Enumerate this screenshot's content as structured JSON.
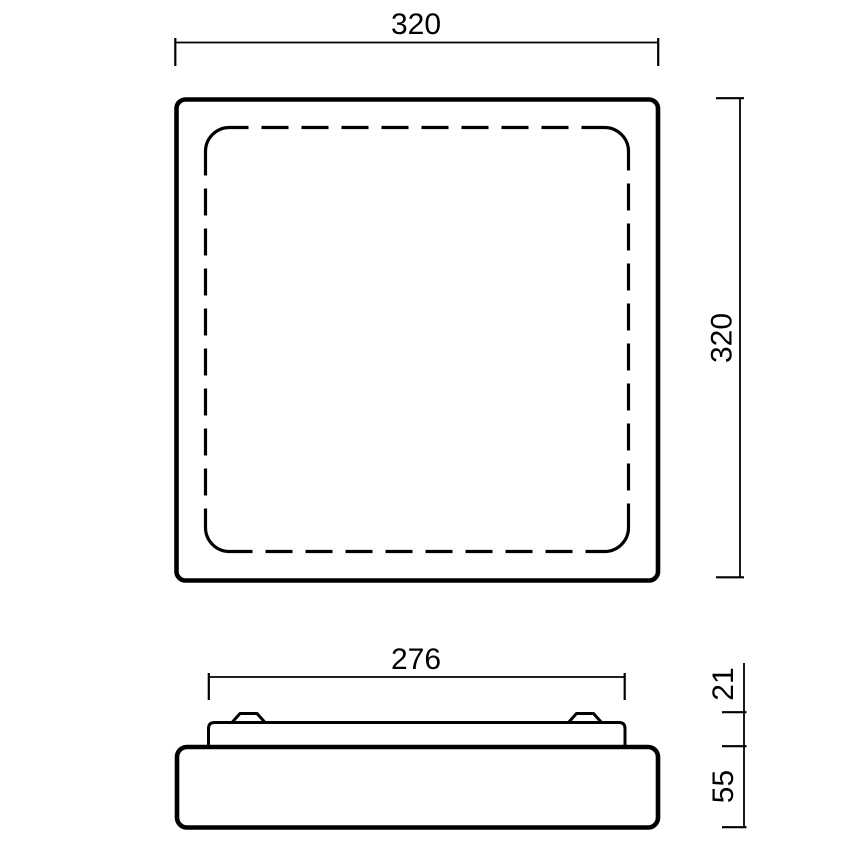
{
  "meta": {
    "drawing_type": "technical-dimension-drawing",
    "background_color": "#ffffff",
    "line_color": "#000000"
  },
  "labels": {
    "top_view_width": "320",
    "top_view_height": "320",
    "side_view_mount_width": "276",
    "side_view_upper_height": "21",
    "side_view_body_height": "55"
  }
}
